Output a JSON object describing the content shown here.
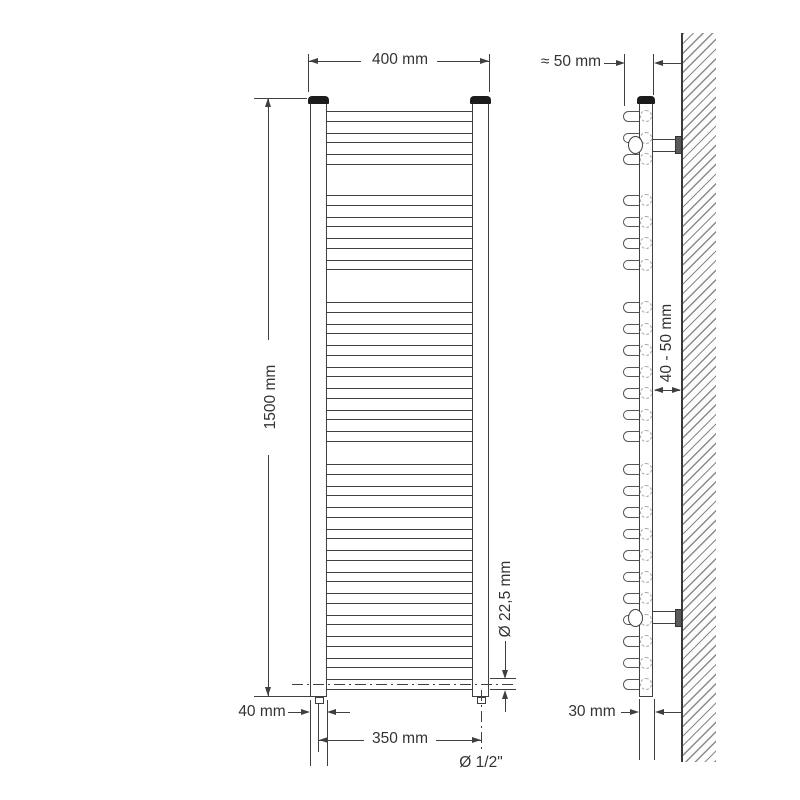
{
  "diagram": {
    "front_view": {
      "width_label": "400 mm",
      "height_label": "1500 mm",
      "rung_diameter_label": "Ø 22,5 mm",
      "edge_offset_label": "40 mm",
      "connection_spacing_label": "350 mm",
      "connection_thread_label": "Ø 1/2\""
    },
    "side_view": {
      "depth_label": "≈ 50 mm",
      "wall_distance_label": "40 - 50 mm",
      "tube_diameter_label": "30 mm"
    },
    "radiator": {
      "rung_groups": [
        {
          "count": 3,
          "start_y": 111
        },
        {
          "count": 4,
          "start_y": 195
        },
        {
          "count": 7,
          "start_y": 302
        },
        {
          "count": 11,
          "start_y": 464
        }
      ],
      "rung_pitch": 21.5,
      "rung_height": 10.5,
      "colors": {
        "line": "#3f3f3f",
        "cap": "#1c1c1c",
        "hatch": "#8a8a8a",
        "background": "#ffffff"
      }
    }
  }
}
